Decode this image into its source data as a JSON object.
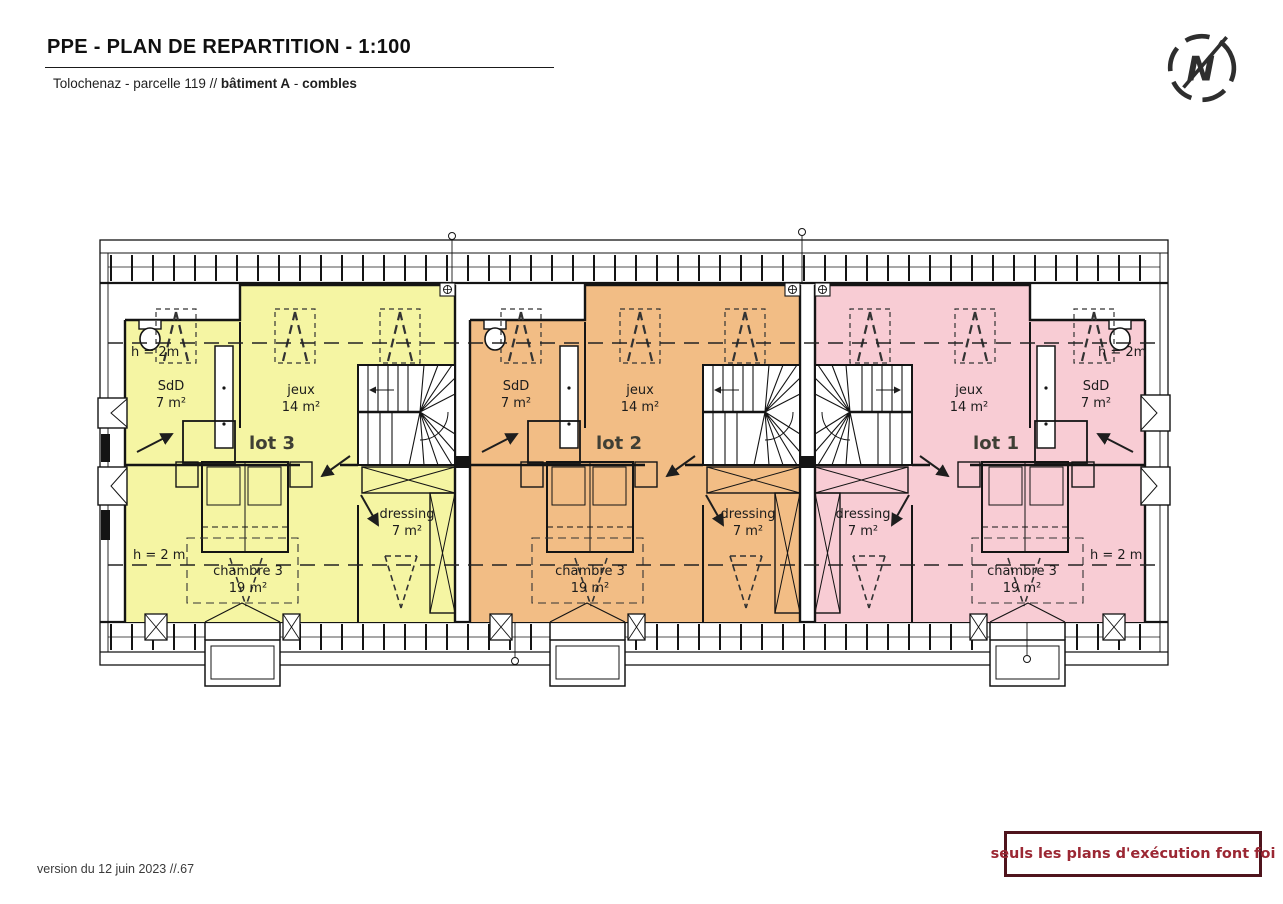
{
  "header": {
    "title": "PPE - PLAN DE REPARTITION - 1:100",
    "location": "Tolochenaz - parcelle 119 // ",
    "building": "bâtiment A",
    "separator": " - ",
    "floor": "combles"
  },
  "compass": {
    "north_letter": "N"
  },
  "plan": {
    "height_note_top": "h = 2m",
    "height_note_bottom": "h = 2 m",
    "lots": [
      {
        "label": "lot 1",
        "color": "#f8ccd4",
        "rooms": {
          "sdd": {
            "name": "SdD",
            "area": "7 m²"
          },
          "jeux": {
            "name": "jeux",
            "area": "14 m²"
          },
          "dressing": {
            "name": "dressing",
            "area": "7 m²"
          },
          "chambre": {
            "name": "chambre 3",
            "area": "19 m²"
          }
        }
      },
      {
        "label": "lot 2",
        "color": "#f2bd85",
        "rooms": {
          "sdd": {
            "name": "SdD",
            "area": "7 m²"
          },
          "jeux": {
            "name": "jeux",
            "area": "14 m²"
          },
          "dressing": {
            "name": "dressing",
            "area": "7 m²"
          },
          "chambre": {
            "name": "chambre 3",
            "area": "19 m²"
          }
        }
      },
      {
        "label": "lot 3",
        "color": "#f5f5a3",
        "rooms": {
          "sdd": {
            "name": "SdD",
            "area": "7 m²"
          },
          "jeux": {
            "name": "jeux",
            "area": "14 m²"
          },
          "dressing": {
            "name": "dressing",
            "area": "7 m²"
          },
          "chambre": {
            "name": "chambre 3",
            "area": "19 m²"
          }
        }
      }
    ],
    "colors": {
      "lot1_fill": "#f8ccd4",
      "lot2_fill": "#f2bd85",
      "lot3_fill": "#f5f5a3",
      "disclaimer_border": "#4f141d",
      "disclaimer_text": "#9b2733"
    }
  },
  "footer": {
    "version": "version du 12 juin 2023 //.67",
    "disclaimer": "seuls les plans d'exécution font foi"
  }
}
